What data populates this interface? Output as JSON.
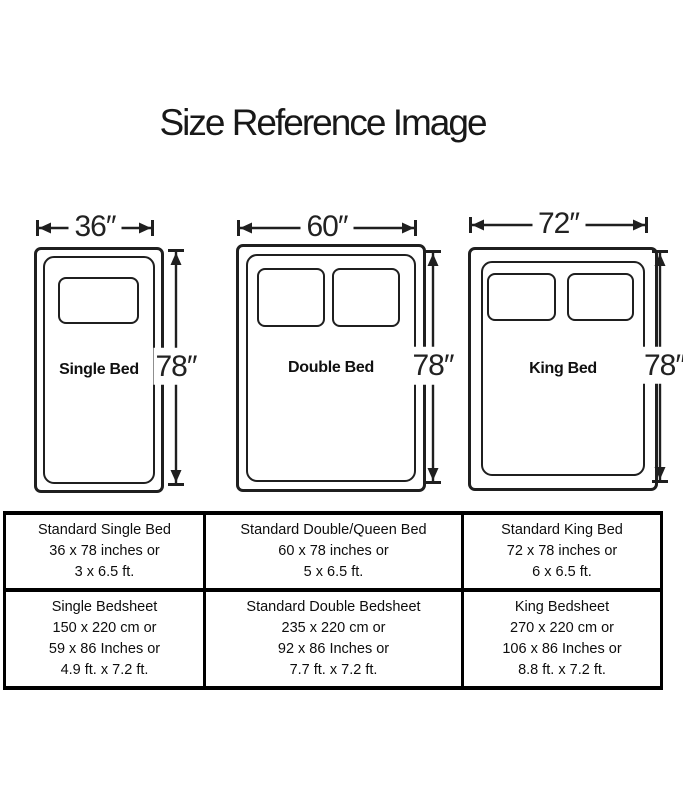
{
  "title": "Size Reference Image",
  "diagram": {
    "beds": [
      {
        "label": "Single Bed",
        "width": "36″",
        "height": "78″"
      },
      {
        "label": "Double Bed",
        "width": "60″",
        "height": "78″"
      },
      {
        "label": "King Bed",
        "width": "72″",
        "height": "78″"
      }
    ]
  },
  "table": {
    "rows": [
      {
        "cells": [
          {
            "lines": [
              "Standard Single Bed",
              "36 x 78 inches or",
              "3 x 6.5 ft."
            ]
          },
          {
            "lines": [
              "Standard Double/Queen Bed",
              "60 x 78 inches or",
              "5 x 6.5 ft."
            ]
          },
          {
            "lines": [
              "Standard King Bed",
              "72 x 78 inches or",
              "6 x 6.5 ft."
            ]
          }
        ]
      },
      {
        "cells": [
          {
            "lines": [
              "Single Bedsheet",
              "150 x 220 cm or",
              "59 x 86 Inches or",
              "4.9 ft. x 7.2 ft."
            ]
          },
          {
            "lines": [
              "Standard Double Bedsheet",
              "235 x 220 cm or",
              "92 x 86 Inches or",
              "7.7 ft. x 7.2 ft."
            ]
          },
          {
            "lines": [
              "King Bedsheet",
              "270 x 220 cm or",
              "106 x 86 Inches or",
              "8.8 ft. x 7.2 ft."
            ]
          }
        ]
      }
    ]
  }
}
